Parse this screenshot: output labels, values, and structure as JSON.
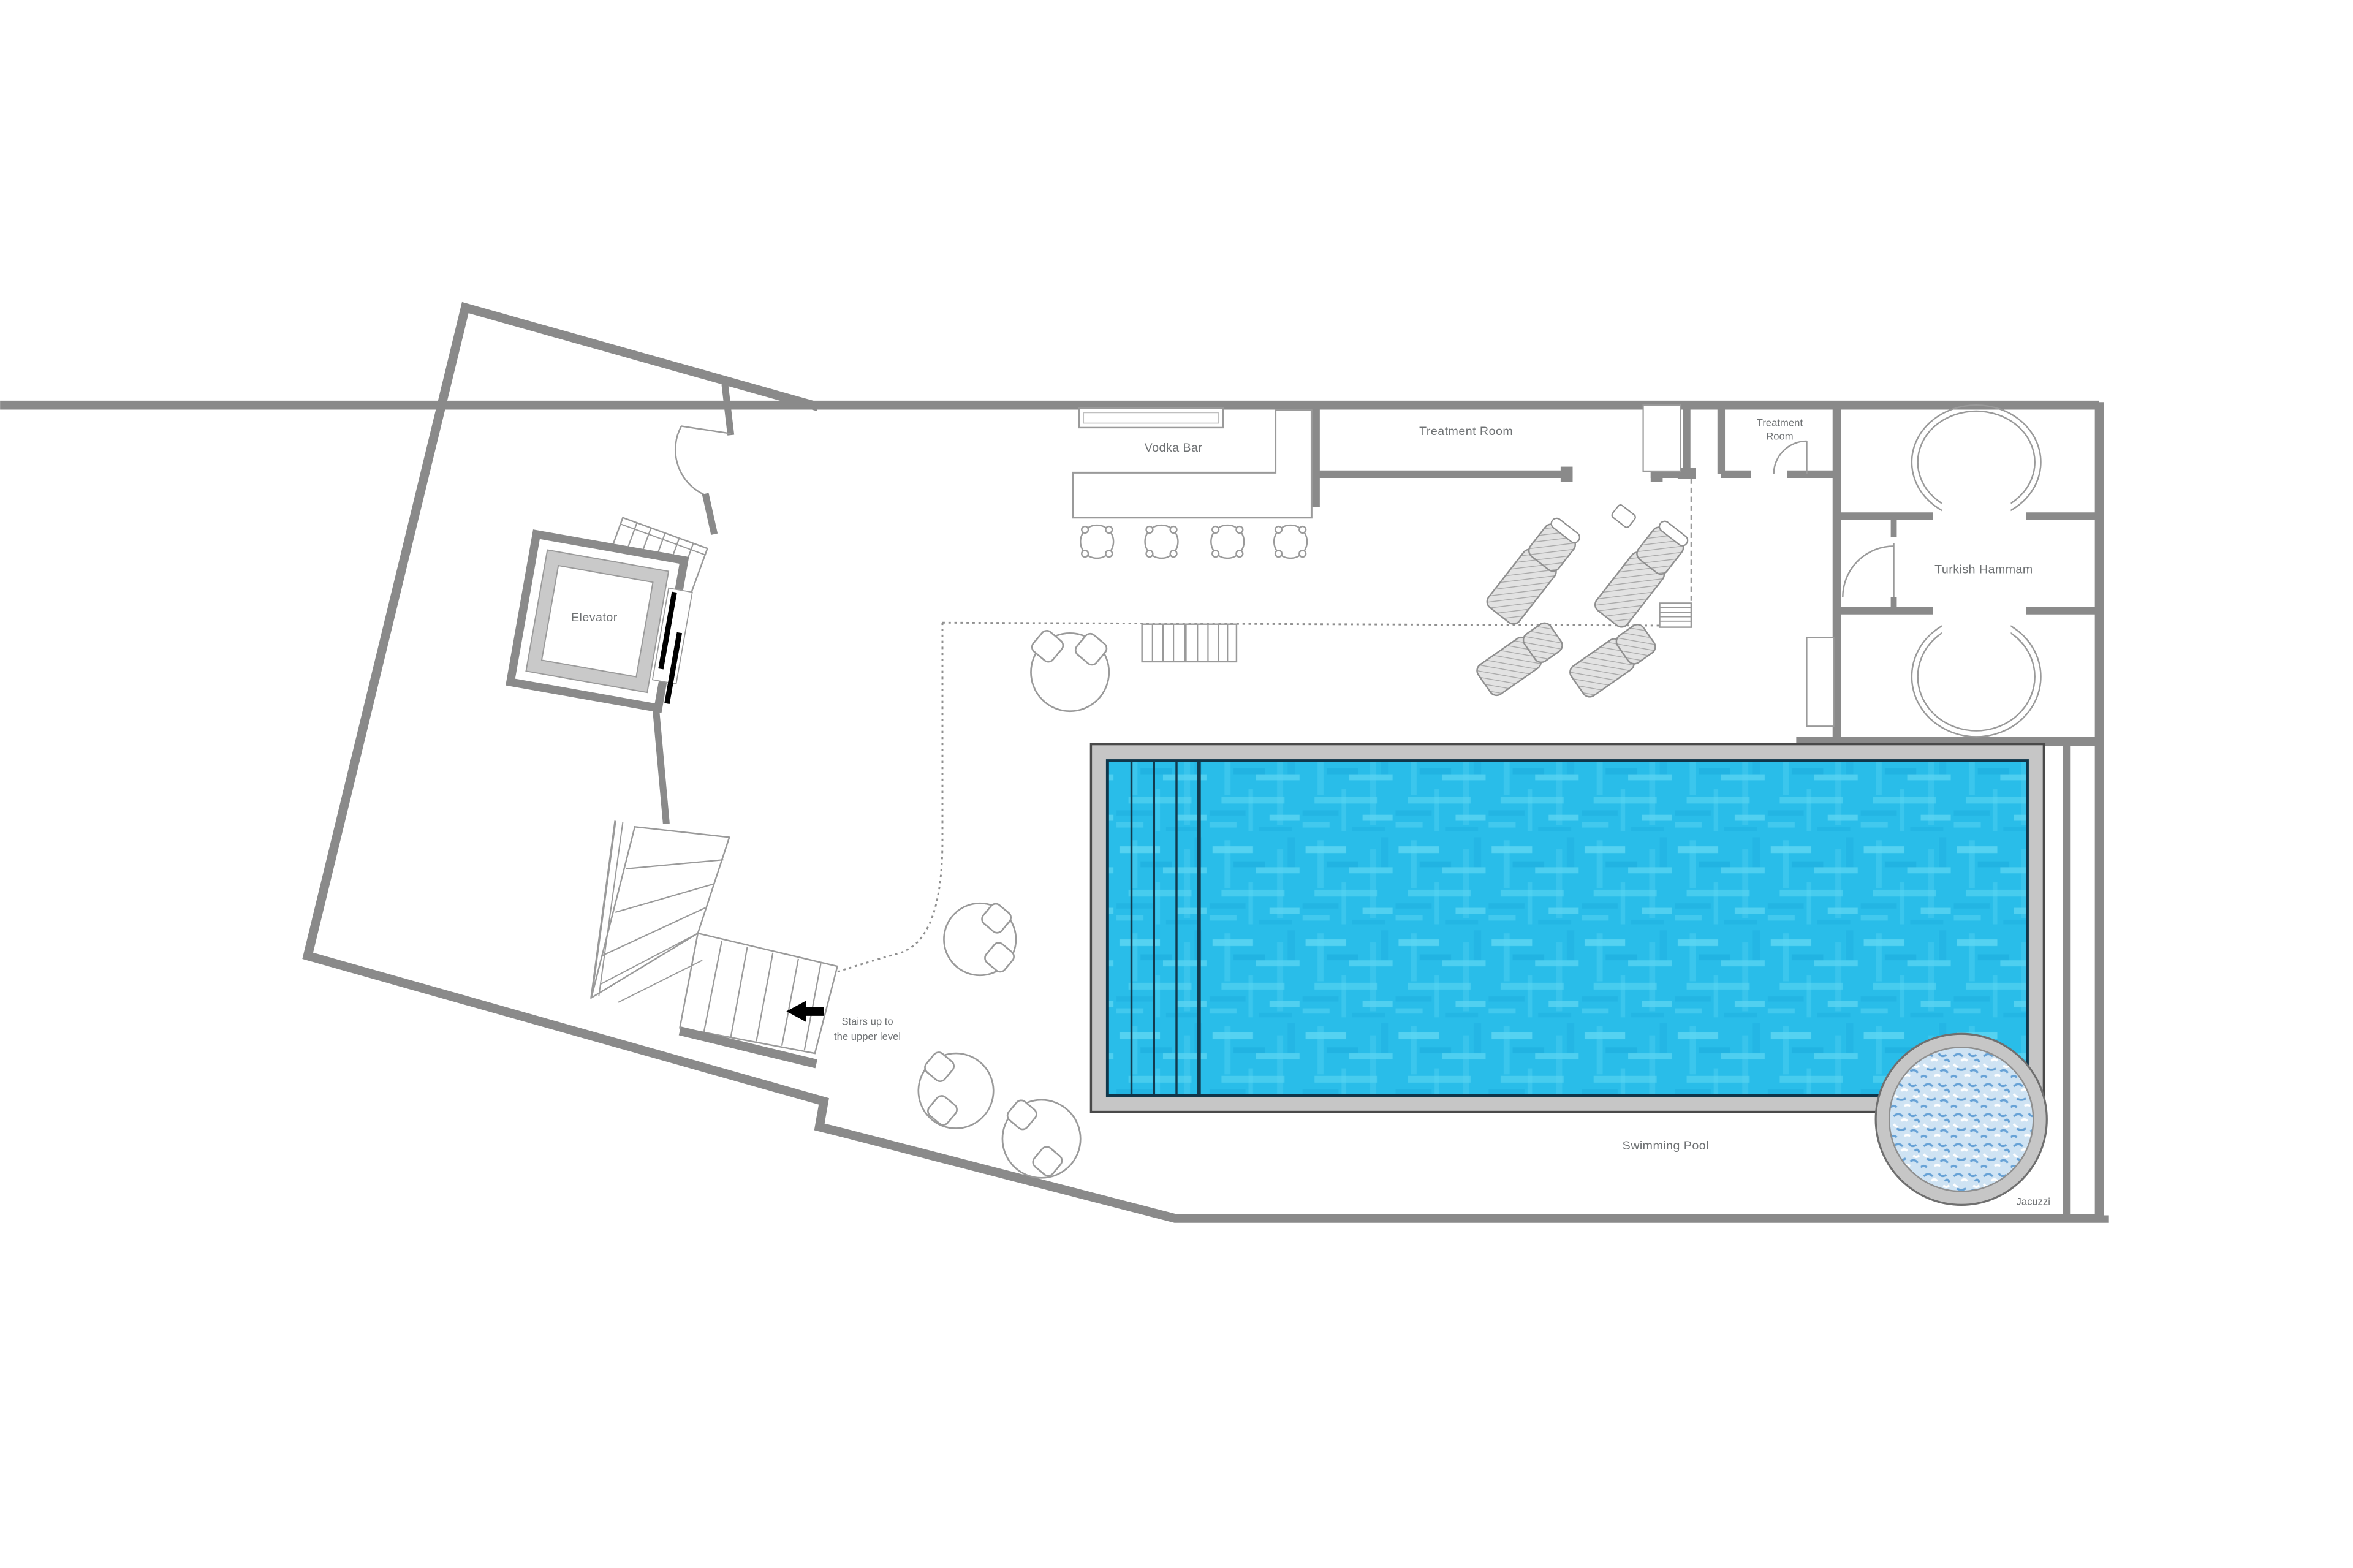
{
  "plan": {
    "type": "architectural-floor-plan",
    "level": "spa-and-pool-level",
    "labels": {
      "vodka_bar": "Vodka Bar",
      "treatment_room": "Treatment Room",
      "treatment_room_small_line1": "Treatment",
      "treatment_room_small_line2": "Room",
      "turkish_hammam": "Turkish Hammam",
      "elevator": "Elevator",
      "stairs_note_line1": "Stairs up to",
      "stairs_note_line2": "the upper level",
      "swimming_pool": "Swimming Pool",
      "jacuzzi": "Jacuzzi"
    },
    "colors": {
      "wall": "#8a8a8a",
      "wall_light_frame": "#c9c9c9",
      "pool_deck": "#c6c6c6",
      "pool_water": "#29bde9",
      "pool_water_highlight": "#7ae4f8",
      "pool_water_shadow": "#119fd4",
      "pool_border": "#10364a",
      "lane_line": "#123a4e",
      "jacuzzi_water_base": "#cfe3f3",
      "jacuzzi_water_speckle": "#5c9bd3",
      "furniture_line": "#9a9a9a",
      "lounger_fill": "#e2e2e2",
      "label_text": "#6e7173",
      "elevator_door_mark": "#000000",
      "background": "#ffffff"
    },
    "furniture": {
      "bar_stools": 4,
      "sun_loungers": 4,
      "round_tables_with_chairs": 4,
      "steam_room_ovals": 2,
      "pool_lane_lines": 4
    }
  }
}
